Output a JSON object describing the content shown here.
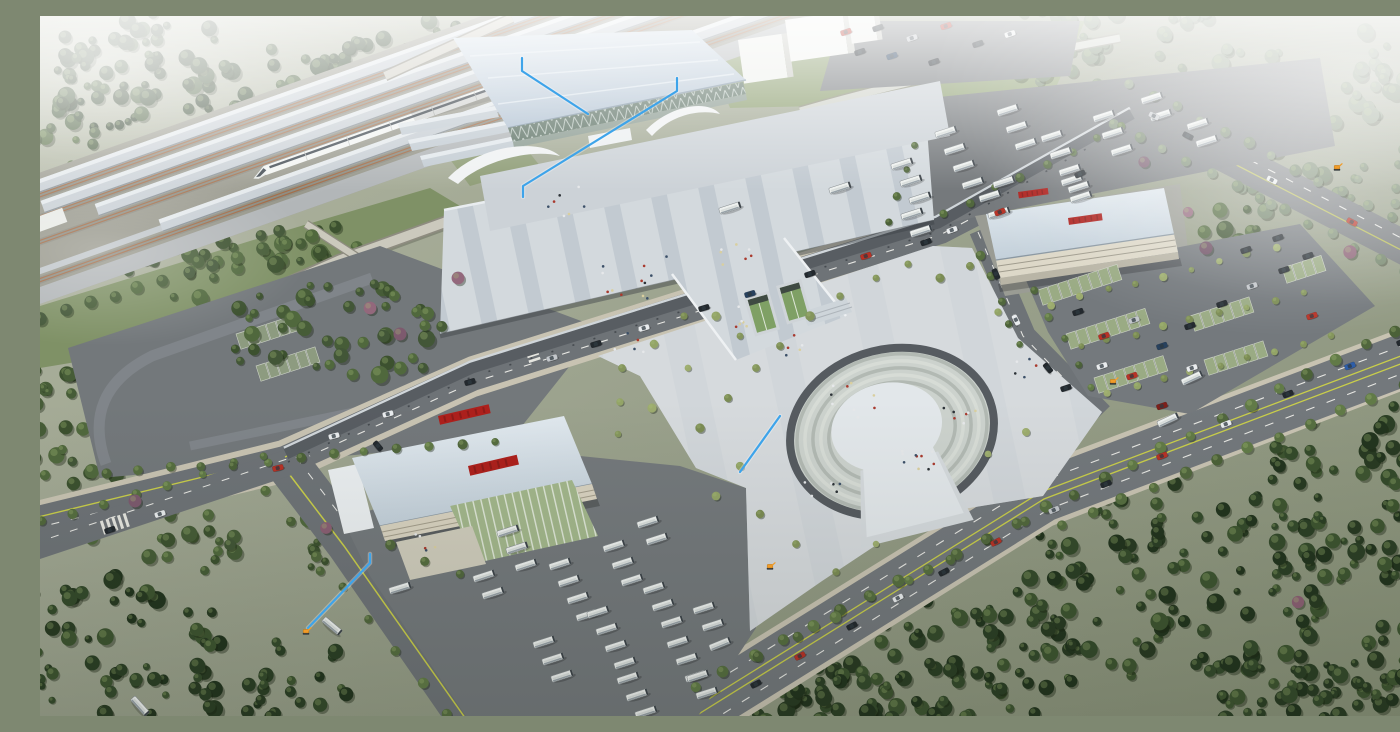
{
  "meta": {
    "title": "Aerial rendering of a railway station complex",
    "description": "Bird's-eye 3D architectural visualization: high-speed rail platforms with a white train, a glass-fronted station hall with light-blue roof, an elevated striped pedestrian deck and long dark canopy, a horseshoe-shaped sunken plaza, a bus terminal building with red signage, bus and car parking yards, diagonal tree-lined roads and dense hazy forest, annotated with light-blue leader lines and small orange site markers."
  },
  "palette": {
    "annotation_blue": "#3ea4ea",
    "marker_orange": "#f09c2a",
    "sign_red": "#ad201c",
    "station_roof": "#c6d4e2",
    "glass_green": "#5e7366",
    "asphalt": "#6e7377",
    "plaza_light": "#d5dadd",
    "lane_yellow": "#c9ce4a"
  },
  "annotations": {
    "line_color": "#3ea4ea",
    "marker_color": "#f09c2a",
    "lines": [
      {
        "id": "station-roof-leader",
        "points": [
          [
            482,
            42
          ],
          [
            482,
            55
          ],
          [
            548,
            98
          ]
        ]
      },
      {
        "id": "station-facade-leader",
        "points": [
          [
            637,
            62
          ],
          [
            637,
            75
          ],
          [
            483,
            170
          ],
          [
            483,
            181
          ]
        ]
      },
      {
        "id": "terminal-leader",
        "points": [
          [
            330,
            538
          ],
          [
            330,
            547
          ],
          [
            268,
            612
          ]
        ]
      },
      {
        "id": "plaza-leader",
        "points": [
          [
            740,
            400
          ],
          [
            700,
            456
          ]
        ]
      }
    ],
    "markers": [
      {
        "id": "marker-terminal",
        "x": 266,
        "y": 616
      },
      {
        "id": "marker-plaza-road",
        "x": 730,
        "y": 551
      },
      {
        "id": "marker-car-park",
        "x": 1073,
        "y": 366
      },
      {
        "id": "marker-far-road",
        "x": 1297,
        "y": 152
      }
    ]
  },
  "vegetation": {
    "highlight": "#aabf7c",
    "palettes": {
      "dark": [
        "#22341e",
        "#2b3f25",
        "#344a2b",
        "#3d5430",
        "#283a22"
      ],
      "darkmid": [
        "#3c512f",
        "#465c37",
        "#50683d",
        "#425637"
      ],
      "mid": [
        "#4b6138",
        "#566e40",
        "#617a47",
        "#51673d"
      ],
      "olive": [
        "#84955c",
        "#93a467",
        "#7b8c54",
        "#9cab6e"
      ],
      "hazy": [
        "#66795e",
        "#72846a",
        "#7e8f76",
        "#6d8065"
      ],
      "purple": [
        "#7d5a6e",
        "#8a5f73",
        "#6e4f63",
        "#93687c"
      ]
    },
    "clusters": [
      [
        120,
        62,
        250,
        130,
        85,
        "dark",
        "forest"
      ],
      [
        360,
        55,
        240,
        110,
        75,
        "dark",
        "forest"
      ],
      [
        560,
        28,
        160,
        60,
        30,
        "dark",
        "forest"
      ],
      [
        205,
        250,
        290,
        85,
        55,
        "darkmid",
        "forest"
      ],
      [
        30,
        150,
        90,
        110,
        20,
        "darkmid",
        "forest"
      ],
      [
        1120,
        55,
        280,
        130,
        60,
        "hazy",
        "forest"
      ],
      [
        1300,
        150,
        220,
        170,
        55,
        "hazy",
        "forest"
      ],
      [
        1000,
        25,
        140,
        70,
        25,
        "hazy",
        "forest"
      ],
      [
        1360,
        40,
        90,
        80,
        20,
        "hazy",
        "forest"
      ],
      [
        880,
        645,
        330,
        150,
        95,
        "dark",
        "forest"
      ],
      [
        1140,
        565,
        330,
        200,
        110,
        "dark",
        "forest"
      ],
      [
        1320,
        470,
        190,
        210,
        65,
        "dark",
        "forest"
      ],
      [
        760,
        685,
        190,
        80,
        35,
        "dark",
        "forest"
      ],
      [
        1365,
        655,
        110,
        100,
        30,
        "dark",
        "forest"
      ],
      [
        1240,
        670,
        200,
        80,
        40,
        "dark",
        "forest"
      ],
      [
        75,
        625,
        210,
        160,
        55,
        "dark",
        "forest"
      ],
      [
        235,
        665,
        170,
        90,
        28,
        "dark",
        "forest"
      ],
      [
        38,
        485,
        130,
        90,
        22,
        "darkmid",
        "forest"
      ],
      [
        150,
        525,
        110,
        70,
        18,
        "darkmid",
        "forest"
      ],
      [
        12,
        395,
        70,
        110,
        16,
        "darkmid",
        "forest"
      ],
      [
        282,
        522,
        55,
        75,
        16,
        "darkmid",
        "forest"
      ],
      [
        1190,
        225,
        90,
        70,
        16,
        "darkmid",
        "forest"
      ],
      [
        300,
        318,
        230,
        110,
        45,
        "darkmid",
        "trees"
      ]
    ],
    "rows": [
      [
        655,
        670,
        1385,
        300,
        26,
        5.5,
        "mid"
      ],
      [
        718,
        640,
        985,
        505,
        8,
        5,
        "mid"
      ],
      [
        1020,
        508,
        1395,
        358,
        13,
        5.5,
        "mid"
      ],
      [
        1090,
        66,
        1398,
        226,
        14,
        5,
        "hazy"
      ],
      [
        1075,
        108,
        1388,
        268,
        14,
        5,
        "hazy"
      ],
      [
        65,
        458,
        455,
        426,
        13,
        4.5,
        "mid"
      ],
      [
        0,
        505,
        225,
        442,
        8,
        4.5,
        "mid"
      ],
      [
        225,
        475,
        408,
        698,
        8,
        5,
        "mid"
      ],
      [
        905,
        198,
        1082,
        110,
        8,
        4,
        "mid"
      ],
      [
        850,
        208,
        874,
        128,
        4,
        4,
        "mid"
      ],
      [
        0,
        302,
        295,
        212,
        13,
        6,
        "darkmid"
      ],
      [
        940,
        238,
        980,
        330,
        5,
        4,
        "mid"
      ],
      [
        996,
        276,
        1052,
        372,
        5,
        4,
        "mid"
      ],
      [
        1012,
        288,
        1235,
        232,
        9,
        3.5,
        "olive"
      ],
      [
        1040,
        332,
        1262,
        276,
        9,
        3.5,
        "olive"
      ],
      [
        1068,
        376,
        1290,
        320,
        9,
        3.5,
        "olive"
      ],
      [
        352,
        528,
        420,
        560,
        3,
        4.5,
        "mid"
      ]
    ],
    "plaza_trees": [
      [
        582,
        352
      ],
      [
        614,
        328
      ],
      [
        648,
        352
      ],
      [
        612,
        392
      ],
      [
        578,
        418
      ],
      [
        660,
        412
      ],
      [
        688,
        382
      ],
      [
        716,
        352
      ],
      [
        700,
        320
      ],
      [
        740,
        330
      ],
      [
        770,
        300
      ],
      [
        800,
        280
      ],
      [
        836,
        262
      ],
      [
        868,
        248
      ],
      [
        900,
        262
      ],
      [
        930,
        250
      ],
      [
        958,
        296
      ],
      [
        700,
        450
      ],
      [
        676,
        480
      ],
      [
        720,
        498
      ],
      [
        756,
        528
      ],
      [
        796,
        556
      ],
      [
        836,
        528
      ],
      [
        948,
        438
      ],
      [
        986,
        416
      ],
      [
        580,
        386
      ],
      [
        644,
        300
      ],
      [
        676,
        300
      ]
    ],
    "purple_trees": [
      [
        330,
        292
      ],
      [
        360,
        318
      ],
      [
        286,
        512
      ],
      [
        1148,
        196
      ],
      [
        1166,
        232
      ],
      [
        1104,
        146
      ],
      [
        1258,
        586
      ],
      [
        95,
        485
      ],
      [
        418,
        262
      ],
      [
        1310,
        236
      ]
    ]
  },
  "vehicles": {
    "bus_body": "#eef1ef",
    "bus_columns": [
      [
        468,
        515,
        3
      ],
      [
        520,
        548,
        4
      ],
      [
        574,
        530,
        3
      ],
      [
        558,
        596,
        4
      ],
      [
        614,
        572,
        3
      ],
      [
        638,
        626,
        3
      ],
      [
        664,
        592,
        2
      ],
      [
        504,
        626,
        3
      ],
      [
        588,
        662,
        3
      ],
      [
        658,
        660,
        2
      ],
      [
        444,
        560,
        2
      ],
      [
        608,
        506,
        2
      ],
      [
        862,
        148,
        3
      ],
      [
        906,
        116,
        4
      ],
      [
        968,
        94,
        3
      ],
      [
        1012,
        120,
        4
      ],
      [
        1064,
        100,
        3
      ],
      [
        1112,
        82,
        2
      ],
      [
        950,
        180,
        2
      ],
      [
        1032,
        164,
        2
      ],
      [
        872,
        198,
        2
      ],
      [
        1158,
        108,
        2
      ]
    ],
    "buses_single": [
      [
        1128,
        404,
        -25
      ],
      [
        1152,
        362,
        -25
      ],
      [
        680,
        628,
        -22
      ],
      [
        360,
        572,
        -17
      ],
      [
        292,
        610,
        40
      ],
      [
        800,
        172,
        -18
      ],
      [
        690,
        192,
        -18
      ],
      [
        964,
        166,
        -18
      ],
      [
        100,
        690,
        48
      ]
    ],
    "car_colors": {
      "red": "#b83226",
      "dark": "#23292e",
      "white": "#e9ecee",
      "silver": "#c3c7cb",
      "navy": "#27415e",
      "blue": "#2e5ea8",
      "dkred": "#7e1f1a"
    },
    "cars": [
      [
        512,
        342,
        "silver",
        -17
      ],
      [
        556,
        328,
        "dark",
        -17
      ],
      [
        604,
        312,
        "white",
        -17
      ],
      [
        664,
        292,
        "dark",
        -17
      ],
      [
        710,
        278,
        "navy",
        -17
      ],
      [
        770,
        258,
        "dark",
        -18
      ],
      [
        826,
        240,
        "red",
        -18
      ],
      [
        430,
        366,
        "dark",
        -16
      ],
      [
        348,
        398,
        "white",
        -15
      ],
      [
        238,
        452,
        "red",
        -14
      ],
      [
        294,
        420,
        "white",
        -15
      ],
      [
        960,
        196,
        "red",
        -22
      ],
      [
        1040,
        158,
        "dark",
        -24
      ],
      [
        716,
        668,
        "dark",
        -27
      ],
      [
        760,
        640,
        "red",
        -27
      ],
      [
        812,
        610,
        "dark",
        -27
      ],
      [
        858,
        582,
        "white",
        -27
      ],
      [
        904,
        556,
        "dark",
        -27
      ],
      [
        956,
        526,
        "red",
        -27
      ],
      [
        1014,
        494,
        "silver",
        -23
      ],
      [
        1066,
        468,
        "dark",
        -23
      ],
      [
        1122,
        440,
        "red",
        -22
      ],
      [
        1186,
        408,
        "white",
        -21
      ],
      [
        1248,
        378,
        "dark",
        -21
      ],
      [
        1310,
        350,
        "blue",
        -21
      ],
      [
        1362,
        326,
        "dark",
        -21
      ],
      [
        956,
        258,
        "dark",
        66
      ],
      [
        976,
        304,
        "white",
        64
      ],
      [
        1008,
        352,
        "dark",
        50
      ],
      [
        1148,
        120,
        "dark",
        27
      ],
      [
        1232,
        164,
        "white",
        27
      ],
      [
        1312,
        206,
        "red",
        27
      ],
      [
        1114,
        100,
        "silver",
        27
      ],
      [
        806,
        16,
        "red",
        -18
      ],
      [
        838,
        12,
        "dark",
        -18
      ],
      [
        872,
        22,
        "silver",
        -18
      ],
      [
        906,
        10,
        "red",
        -18
      ],
      [
        938,
        28,
        "dark",
        -18
      ],
      [
        970,
        18,
        "white",
        -18
      ],
      [
        852,
        40,
        "navy",
        -18
      ],
      [
        894,
        46,
        "dark",
        -18
      ],
      [
        820,
        36,
        "dark",
        -18
      ],
      [
        1038,
        296,
        "dark",
        -18
      ],
      [
        1064,
        320,
        "red",
        -18
      ],
      [
        1094,
        304,
        "silver",
        -18
      ],
      [
        1122,
        330,
        "navy",
        -18
      ],
      [
        1062,
        350,
        "white",
        -18
      ],
      [
        1150,
        310,
        "dark",
        -18
      ],
      [
        1092,
        360,
        "red",
        -18
      ],
      [
        1182,
        288,
        "dark",
        -18
      ],
      [
        1212,
        270,
        "silver",
        -18
      ],
      [
        1244,
        254,
        "dark",
        -18
      ],
      [
        1272,
        300,
        "red",
        -18
      ],
      [
        1152,
        352,
        "white",
        -18
      ],
      [
        1026,
        372,
        "dark",
        -18
      ],
      [
        1122,
        390,
        "dkred",
        -18
      ],
      [
        1206,
        234,
        "dark",
        -18
      ],
      [
        1238,
        222,
        "dark",
        -18
      ],
      [
        1268,
        240,
        "dark",
        -18
      ],
      [
        120,
        498,
        "white",
        -18
      ],
      [
        70,
        514,
        "dark",
        -18
      ],
      [
        338,
        430,
        "dark",
        50
      ],
      [
        912,
        214,
        "white",
        -20
      ],
      [
        886,
        226,
        "dark",
        -20
      ]
    ]
  },
  "parking": {
    "stall_green": "#9aab84",
    "stall_gray_green": "#8d9b80",
    "green_stall_rows": [
      [
        998,
        274,
        8
      ],
      [
        1026,
        318,
        8
      ],
      [
        1054,
        362,
        7
      ],
      [
        1150,
        300,
        6
      ],
      [
        1164,
        344,
        6
      ],
      [
        1242,
        252,
        4
      ]
    ],
    "left_lot_rows": [
      [
        196,
        318,
        6
      ],
      [
        216,
        350,
        6
      ]
    ]
  },
  "people": {
    "colors": [
      "#2c3237",
      "#e6e8ea",
      "#a93a2e",
      "#3c5068",
      "#d9cf9f"
    ],
    "clusters": [
      [
        600,
        262,
        42,
        12
      ],
      [
        692,
        238,
        26,
        7
      ],
      [
        700,
        302,
        18,
        6
      ],
      [
        812,
        382,
        30,
        9
      ],
      [
        876,
        440,
        26,
        12
      ],
      [
        920,
        396,
        18,
        7
      ],
      [
        784,
        470,
        20,
        6
      ],
      [
        984,
        352,
        14,
        5
      ],
      [
        528,
        186,
        26,
        7
      ],
      [
        386,
        524,
        16,
        5
      ],
      [
        588,
        330,
        20,
        5
      ],
      [
        752,
        330,
        16,
        5
      ]
    ]
  }
}
